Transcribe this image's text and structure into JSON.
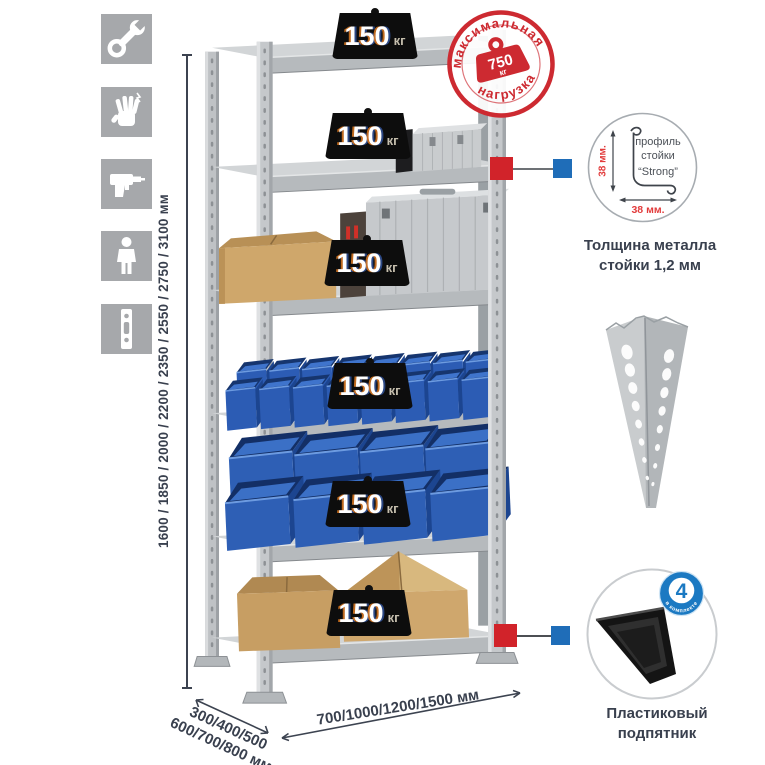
{
  "tool_icons": [
    {
      "name": "wrench"
    },
    {
      "name": "work-gloves"
    },
    {
      "name": "drill"
    },
    {
      "name": "person"
    },
    {
      "name": "rack-post"
    }
  ],
  "height_dim": {
    "label": "1600 / 1850 / 2000 / 2200 / 2350 / 2550 / 2750 / 3100 мм"
  },
  "load_badges": [
    {
      "value": "150",
      "unit": "кг"
    },
    {
      "value": "150",
      "unit": "кг"
    },
    {
      "value": "150",
      "unit": "кг"
    },
    {
      "value": "150",
      "unit": "кг"
    },
    {
      "value": "150",
      "unit": "кг"
    },
    {
      "value": "150",
      "unit": "кг"
    }
  ],
  "max_load_stamp": {
    "arc_top": "максимальная",
    "arc_bottom": "нагрузка",
    "value": "750",
    "unit": "кг"
  },
  "post_profile": {
    "label_line1": "профиль",
    "label_line2": "стойки",
    "label_line3": "“Strong”",
    "dim_vertical": "38 мм.",
    "dim_horizontal": "38 мм.",
    "caption_line1": "Толщина металла",
    "caption_line2": "стойки 1,2 мм"
  },
  "foot": {
    "badge_value": "4",
    "badge_arc": "в комплекте",
    "caption_line1": "Пластиковый",
    "caption_line2": "подпятник"
  },
  "depth_dim": {
    "line1": "300/400/500",
    "line2": "600/700/800 мм"
  },
  "width_dim": {
    "label": "700/1000/1200/1500 мм"
  },
  "colors": {
    "accent_red": "#cd2a31",
    "marker_red": "#d1232a",
    "marker_blue": "#1f6db8",
    "badge_blue": "#1b79c2",
    "text_navy": "#39404e",
    "bin_blue": "#2e5fb5"
  }
}
